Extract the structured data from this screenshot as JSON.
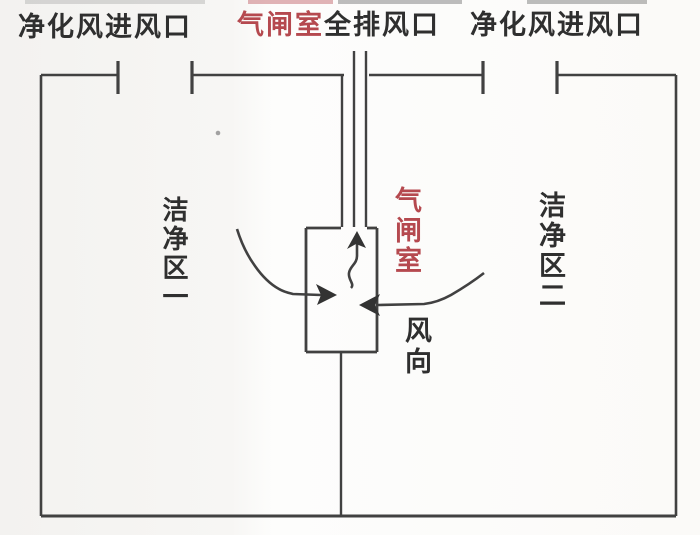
{
  "diagram": {
    "type": "cleanroom-airlock-airflow-schematic",
    "labels": {
      "top_left_inlet": "净化风进风口",
      "top_center_airlock": "气闸室",
      "top_center_exhaust": "全排风口",
      "top_right_inlet": "净化风进风口",
      "clean_zone_1": "洁净区一",
      "airlock_room": "气闸室",
      "clean_zone_2": "洁净区二",
      "wind_direction": "风向"
    },
    "colors": {
      "line": "#414141",
      "text": "#2f2f2f",
      "accent_red": "#b5494f",
      "background": "#f8f7f5"
    }
  }
}
